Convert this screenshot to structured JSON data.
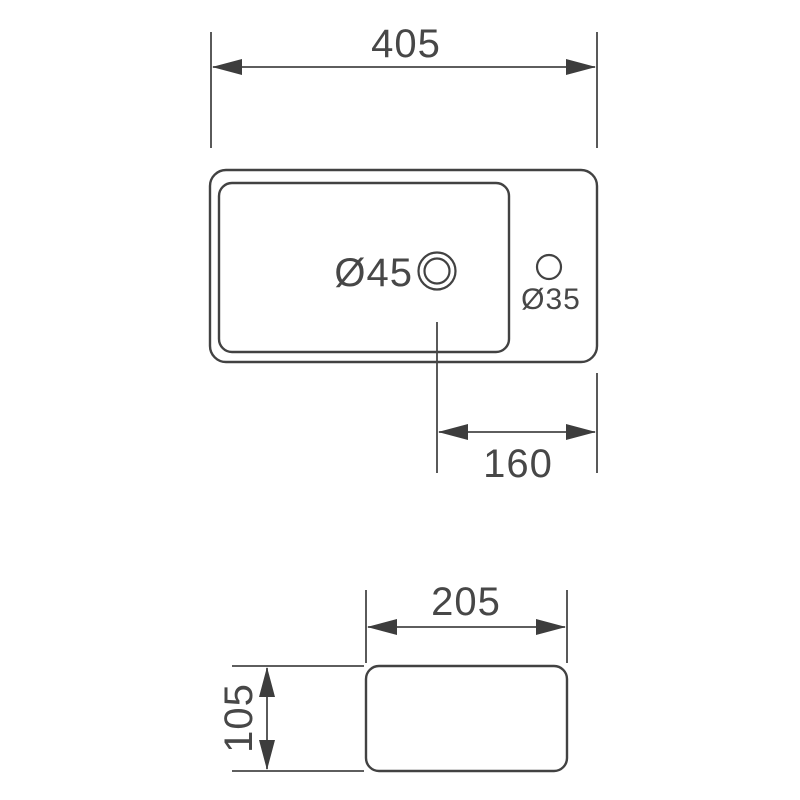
{
  "drawing": {
    "colors": {
      "line": "#424242",
      "dimension": "#474747",
      "background": "#ffffff"
    },
    "top_view": {
      "width_dim": "405",
      "drain_dia": "Ø45",
      "faucet_dia": "Ø35",
      "drain_offset_dim": "160"
    },
    "side_view": {
      "width_dim": "205",
      "height_dim": "105"
    }
  }
}
